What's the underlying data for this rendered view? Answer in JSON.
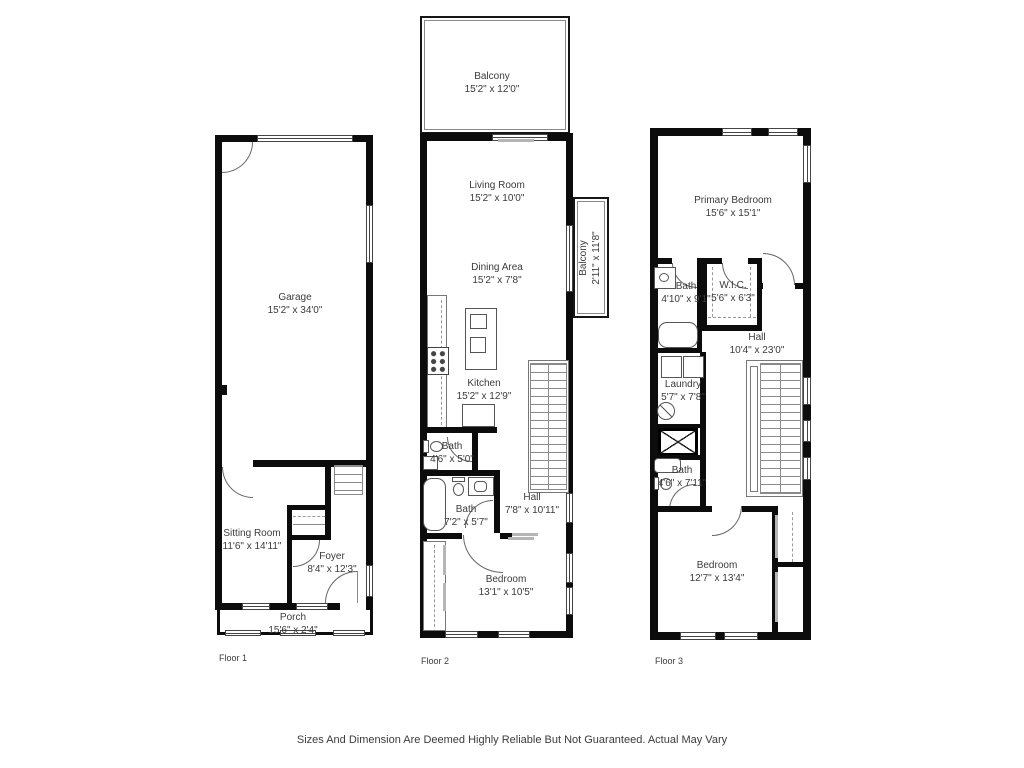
{
  "disclaimer": "Sizes And Dimension Are Deemed Highly Reliable But Not Guaranteed. Actual May Vary",
  "style": {
    "wall_color": "#0c0c0c",
    "text_color": "#3b3b3b",
    "background": "#ffffff"
  },
  "floors": [
    {
      "label": "Floor 1",
      "rooms": [
        {
          "name": "Garage",
          "dims": "15'2\" x 34'0\""
        },
        {
          "name": "Sitting Room",
          "dims": "11'6\" x 14'11\""
        },
        {
          "name": "Foyer",
          "dims": "8'4\" x 12'3\""
        },
        {
          "name": "Porch",
          "dims": "15'6\" x 2'4\""
        }
      ]
    },
    {
      "label": "Floor 2",
      "rooms": [
        {
          "name": "Balcony",
          "dims": "15'2\" x 12'0\""
        },
        {
          "name": "Living Room",
          "dims": "15'2\" x 10'0\""
        },
        {
          "name": "Dining Area",
          "dims": "15'2\" x 7'8\""
        },
        {
          "name": "Balcony",
          "dims": "2'11\" x 11'8\""
        },
        {
          "name": "Kitchen",
          "dims": "15'2\" x 12'9\""
        },
        {
          "name": "Bath",
          "dims": "4'6\" x 5'0\""
        },
        {
          "name": "Bath",
          "dims": "7'2\" x 5'7\""
        },
        {
          "name": "Hall",
          "dims": "7'8\" x 10'11\""
        },
        {
          "name": "Bedroom",
          "dims": "13'1\" x 10'5\""
        }
      ]
    },
    {
      "label": "Floor 3",
      "rooms": [
        {
          "name": "Primary Bedroom",
          "dims": "15'6\" x 15'1\""
        },
        {
          "name": "Bath",
          "dims": "4'10\" x 9'1\""
        },
        {
          "name": "W.I.C.",
          "dims": "5'6\" x 6'3\""
        },
        {
          "name": "Hall",
          "dims": "10'4\" x 23'0\""
        },
        {
          "name": "Laundry",
          "dims": "5'7\" x 7'8\""
        },
        {
          "name": "Bath",
          "dims": "4'6\" x 7'11\""
        },
        {
          "name": "Bedroom",
          "dims": "12'7\" x 13'4\""
        }
      ]
    }
  ]
}
